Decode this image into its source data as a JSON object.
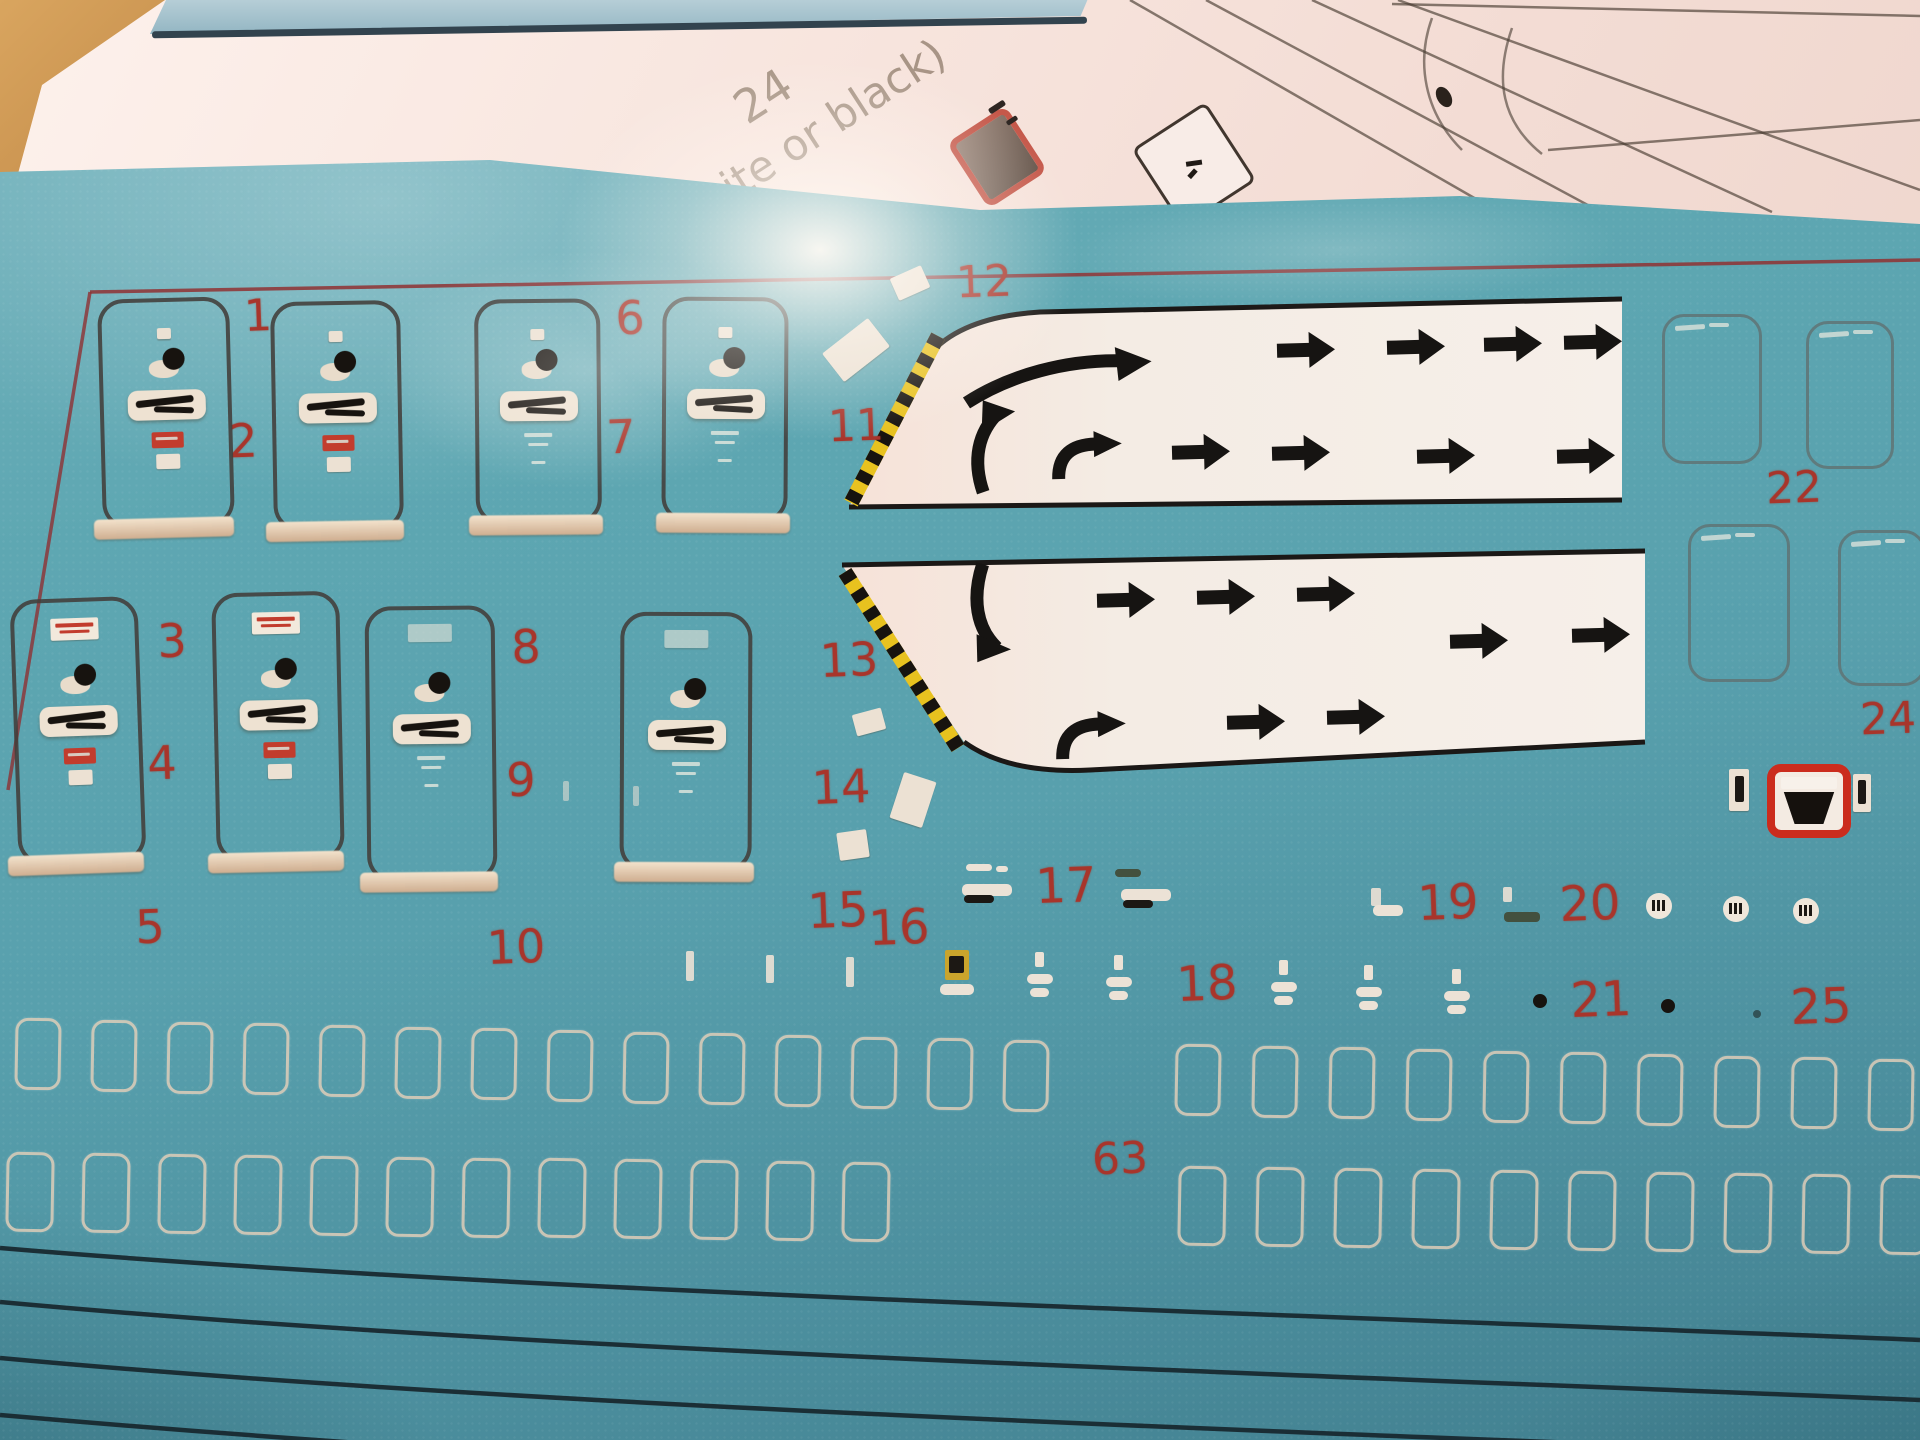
{
  "scene": {
    "teal": "#58a0ad",
    "paper": "#f8e6df",
    "wood": "#c08a4e",
    "number_red": "#a8352b",
    "border_red": "#8f3133",
    "hazard_yellow": "#e8c21f",
    "band_white": "#f4ece4",
    "silver": "#e4cfba",
    "arrow_black": "#161412"
  },
  "paper": {
    "texts": [
      {
        "t": "24",
        "x": 763,
        "y": 96,
        "s": 46,
        "r": -33
      },
      {
        "t": "hite or black)",
        "x": 822,
        "y": 128,
        "s": 43,
        "r": -33
      }
    ],
    "draw_lines": [
      [
        1130,
        0,
        1530,
        230
      ],
      [
        1206,
        0,
        1625,
        225
      ],
      [
        1312,
        0,
        1772,
        212
      ],
      [
        1398,
        0,
        1920,
        190
      ],
      [
        1548,
        150,
        1920,
        120
      ],
      [
        1392,
        4,
        1920,
        16
      ]
    ],
    "nose_curves": [
      "M1432,18 C1416,62 1424,112 1462,150",
      "M1512,28 C1494,80 1502,122 1542,154"
    ]
  },
  "sheet": {
    "labels": [
      {
        "t": "1",
        "x": 258,
        "y": 316,
        "s": 44
      },
      {
        "t": "2",
        "x": 243,
        "y": 441,
        "s": 46
      },
      {
        "t": "3",
        "x": 172,
        "y": 641,
        "s": 46
      },
      {
        "t": "4",
        "x": 162,
        "y": 763,
        "s": 46
      },
      {
        "t": "5",
        "x": 150,
        "y": 927,
        "s": 46
      },
      {
        "t": "6",
        "x": 630,
        "y": 318,
        "s": 46
      },
      {
        "t": "7",
        "x": 621,
        "y": 437,
        "s": 46
      },
      {
        "t": "8",
        "x": 526,
        "y": 647,
        "s": 46
      },
      {
        "t": "9",
        "x": 521,
        "y": 780,
        "s": 46
      },
      {
        "t": "10",
        "x": 516,
        "y": 947,
        "s": 46
      },
      {
        "t": "11",
        "x": 856,
        "y": 426,
        "s": 44
      },
      {
        "t": "12",
        "x": 984,
        "y": 282,
        "s": 44
      },
      {
        "t": "13",
        "x": 849,
        "y": 660,
        "s": 46
      },
      {
        "t": "14",
        "x": 841,
        "y": 787,
        "s": 46
      },
      {
        "t": "15",
        "x": 838,
        "y": 911,
        "s": 48
      },
      {
        "t": "16",
        "x": 899,
        "y": 928,
        "s": 48
      },
      {
        "t": "17",
        "x": 1066,
        "y": 886,
        "s": 48
      },
      {
        "t": "18",
        "x": 1207,
        "y": 984,
        "s": 48
      },
      {
        "t": "19",
        "x": 1448,
        "y": 903,
        "s": 48
      },
      {
        "t": "20",
        "x": 1590,
        "y": 904,
        "s": 48
      },
      {
        "t": "21",
        "x": 1601,
        "y": 1000,
        "s": 48
      },
      {
        "t": "22",
        "x": 1794,
        "y": 488,
        "s": 44
      },
      {
        "t": "24",
        "x": 1888,
        "y": 719,
        "s": 44
      },
      {
        "t": "25",
        "x": 1821,
        "y": 1007,
        "s": 48
      },
      {
        "t": "63",
        "x": 1120,
        "y": 1159,
        "s": 44
      }
    ],
    "doors_row1": [
      {
        "x": 100,
        "y": 298,
        "w": 124,
        "h": 222,
        "v": "A",
        "r": -1.5
      },
      {
        "x": 272,
        "y": 301,
        "w": 122,
        "h": 222,
        "v": "A",
        "r": -1.0
      },
      {
        "x": 475,
        "y": 299,
        "w": 118,
        "h": 218,
        "v": "B",
        "r": -0.5
      },
      {
        "x": 662,
        "y": 297,
        "w": 118,
        "h": 218,
        "v": "B2",
        "r": 0.3
      }
    ],
    "doors_row2": [
      {
        "x": 14,
        "y": 598,
        "w": 120,
        "h": 258,
        "v": "C",
        "r": -2.0
      },
      {
        "x": 214,
        "y": 592,
        "w": 120,
        "h": 262,
        "v": "C",
        "r": -1.2
      },
      {
        "x": 366,
        "y": 606,
        "w": 122,
        "h": 268,
        "v": "B3",
        "r": -0.6
      },
      {
        "x": 620,
        "y": 612,
        "w": 124,
        "h": 252,
        "v": "B3",
        "r": 0.2
      }
    ],
    "doors_small": [
      {
        "x": 1662,
        "y": 314,
        "w": 94,
        "h": 144
      },
      {
        "x": 1806,
        "y": 321,
        "w": 82,
        "h": 142
      },
      {
        "x": 1688,
        "y": 524,
        "w": 96,
        "h": 152
      },
      {
        "x": 1838,
        "y": 530,
        "w": 82,
        "h": 150
      }
    ],
    "bands": [
      {
        "fill": "M1622,299 L1040,312 Q962,317 930,354 L849,507 L1622,500 Z",
        "top": "M1622,299 L1040,312 Q962,317 930,354",
        "bottom": "M849,507 L1622,500",
        "hazard": [
          938,
          336,
          851,
          503
        ]
      },
      {
        "fill": "M842,565 L1645,551 L1645,742 L1090,770 Q1008,774 964,742 L842,565 Z",
        "top": "M842,565 L1645,551",
        "bottom": "M1645,742 L1090,770 Q1008,774 964,742",
        "hazard": [
          845,
          572,
          958,
          748
        ]
      }
    ],
    "arrows": [
      {
        "k": "arc",
        "x": 1060,
        "y": 372,
        "r": -3
      },
      {
        "k": "st",
        "x": 1305,
        "y": 350
      },
      {
        "k": "st",
        "x": 1415,
        "y": 347
      },
      {
        "k": "st",
        "x": 1512,
        "y": 344
      },
      {
        "k": "st",
        "x": 1592,
        "y": 342
      },
      {
        "k": "jup",
        "x": 992,
        "y": 446,
        "r": 0
      },
      {
        "k": "hook",
        "x": 1098,
        "y": 452,
        "r": 0
      },
      {
        "k": "st",
        "x": 1200,
        "y": 452
      },
      {
        "k": "st",
        "x": 1300,
        "y": 453
      },
      {
        "k": "st",
        "x": 1445,
        "y": 456
      },
      {
        "k": "st",
        "x": 1585,
        "y": 456
      },
      {
        "k": "jdn",
        "x": 988,
        "y": 612,
        "r": 0
      },
      {
        "k": "st",
        "x": 1125,
        "y": 600
      },
      {
        "k": "st",
        "x": 1225,
        "y": 597
      },
      {
        "k": "st",
        "x": 1325,
        "y": 594
      },
      {
        "k": "hook",
        "x": 1102,
        "y": 732,
        "r": 0
      },
      {
        "k": "st",
        "x": 1255,
        "y": 722
      },
      {
        "k": "st",
        "x": 1355,
        "y": 717
      },
      {
        "k": "st",
        "x": 1478,
        "y": 641
      },
      {
        "k": "st",
        "x": 1600,
        "y": 635
      }
    ],
    "chips": [
      {
        "x": 910,
        "y": 283,
        "w": 34,
        "h": 24,
        "r": -24
      },
      {
        "x": 856,
        "y": 350,
        "w": 58,
        "h": 36,
        "r": -38
      },
      {
        "x": 869,
        "y": 722,
        "w": 30,
        "h": 22,
        "r": -15
      },
      {
        "x": 913,
        "y": 800,
        "w": 34,
        "h": 48,
        "r": 18
      },
      {
        "x": 853,
        "y": 845,
        "w": 30,
        "h": 28,
        "r": -8
      }
    ],
    "ticks": [
      {
        "x": 563,
        "y": 781,
        "w": 6,
        "h": 20,
        "o": 0.55
      },
      {
        "x": 633,
        "y": 786,
        "w": 6,
        "h": 20,
        "o": 0.55
      },
      {
        "x": 686,
        "y": 951,
        "w": 8,
        "h": 30,
        "o": 0.9
      },
      {
        "x": 766,
        "y": 955,
        "w": 8,
        "h": 28,
        "o": 0.9
      },
      {
        "x": 846,
        "y": 957,
        "w": 8,
        "h": 30,
        "o": 0.9
      },
      {
        "x": 1371,
        "y": 888,
        "w": 10,
        "h": 18,
        "o": 0.9
      },
      {
        "x": 1503,
        "y": 887,
        "w": 9,
        "h": 15,
        "o": 0.9
      }
    ],
    "dash17": [
      {
        "x": 987,
        "y": 890,
        "top": "white"
      },
      {
        "x": 1146,
        "y": 895,
        "top": "olive"
      }
    ],
    "dash19": [
      {
        "x": 1388,
        "y": 910,
        "w": 30,
        "h": 11,
        "c": "light"
      },
      {
        "x": 1522,
        "y": 917,
        "w": 36,
        "h": 10,
        "c": "dark"
      }
    ],
    "flagchips": [
      {
        "x": 1040,
        "y": 976
      },
      {
        "x": 1119,
        "y": 979
      },
      {
        "x": 1284,
        "y": 984
      },
      {
        "x": 1369,
        "y": 989
      },
      {
        "x": 1457,
        "y": 993
      }
    ],
    "yellowchip": {
      "x": 957,
      "y": 972
    },
    "circles": [
      {
        "x": 1659,
        "y": 906
      },
      {
        "x": 1736,
        "y": 909
      },
      {
        "x": 1806,
        "y": 911
      }
    ],
    "dots": [
      {
        "x": 1540,
        "y": 1001,
        "d": 14,
        "o": 1
      },
      {
        "x": 1668,
        "y": 1006,
        "d": 14,
        "o": 1
      },
      {
        "x": 1757,
        "y": 1014,
        "d": 8,
        "o": 0.5
      }
    ],
    "decal24": {
      "x": 1767,
      "y": 764,
      "w": 68,
      "h": 58,
      "lt": {
        "x": 1729,
        "y": 769
      },
      "rt": {
        "x": 1853,
        "y": 774
      }
    },
    "windows": {
      "rowA": {
        "y0": 1018,
        "slope": 0.022,
        "w": 40,
        "h": 66,
        "xs": [
          15,
          91,
          167,
          243,
          319,
          395,
          471,
          547,
          623,
          699,
          775,
          851,
          927,
          1003,
          1175,
          1252,
          1329,
          1406,
          1483,
          1560,
          1637,
          1714,
          1791,
          1868
        ]
      },
      "rowB": {
        "y0": 1152,
        "slope": 0.012,
        "w": 42,
        "h": 74,
        "xs": [
          6,
          82,
          158,
          234,
          310,
          386,
          462,
          538,
          614,
          690,
          766,
          842,
          1178,
          1256,
          1334,
          1412,
          1490,
          1568,
          1646,
          1724,
          1802,
          1880
        ]
      }
    },
    "bottom_lines": [
      "M0,1248 C520,1292 1240,1312 1920,1340",
      "M0,1302 C520,1350 1240,1372 1920,1400",
      "M0,1358 C520,1406 1240,1430 1920,1456",
      "M0,1415 C380,1448 660,1462 860,1472"
    ],
    "border": {
      "top": [
        90,
        292,
        1920,
        260
      ],
      "left": [
        90,
        292,
        8,
        790
      ]
    }
  }
}
